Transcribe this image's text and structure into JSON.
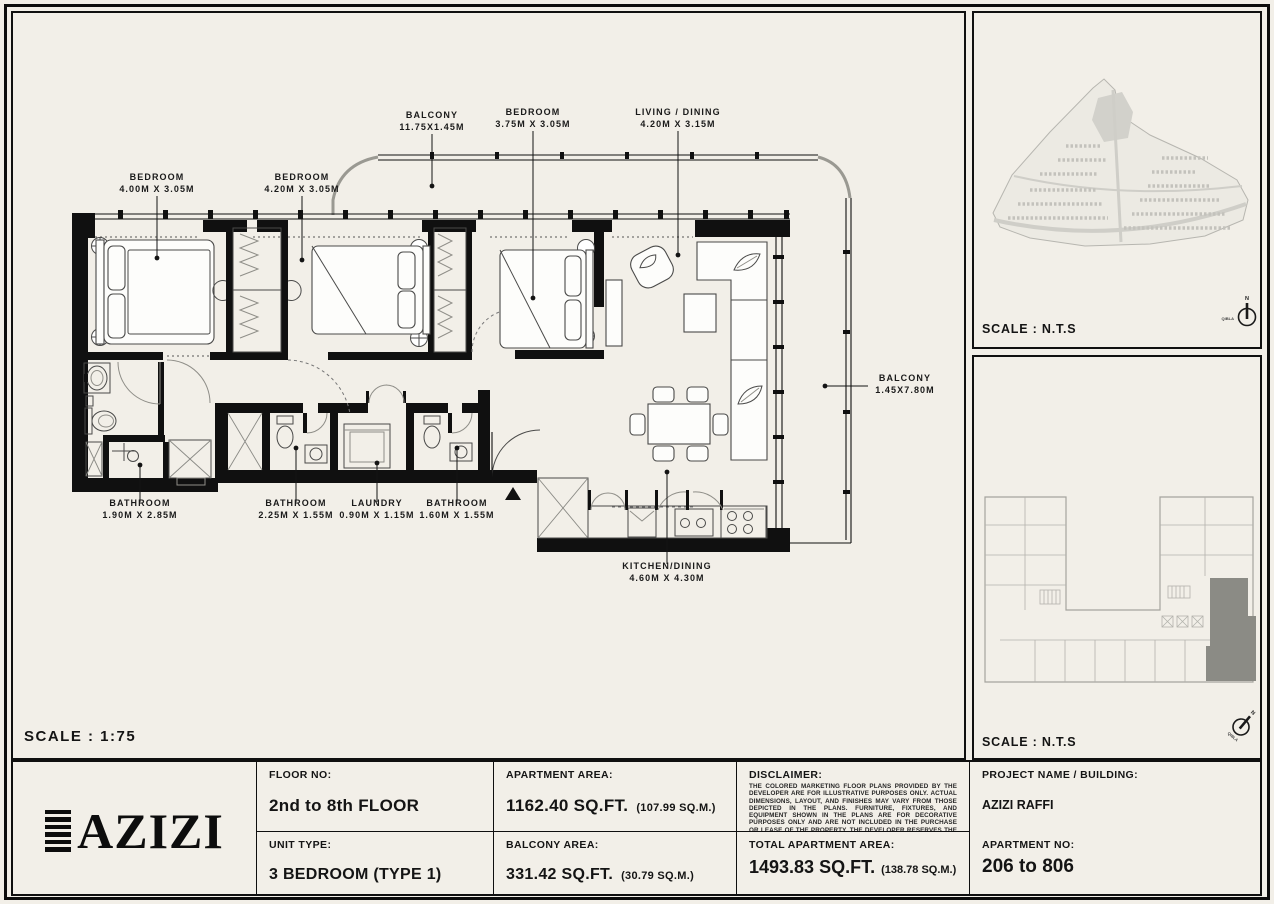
{
  "sheet": {
    "scale_main": "SCALE : 1:75",
    "colors": {
      "paper": "#F2EFE8",
      "ink": "#101010",
      "unit_highlight": "#8B8B85",
      "map_gray": "#C4C3BD"
    }
  },
  "plan": {
    "rooms": [
      {
        "name": "BEDROOM",
        "dims": "4.00M X 3.05M"
      },
      {
        "name": "BEDROOM",
        "dims": "4.20M X 3.05M"
      },
      {
        "name": "BALCONY",
        "dims": "11.75X1.45M"
      },
      {
        "name": "BEDROOM",
        "dims": "3.75M X 3.05M"
      },
      {
        "name": "LIVING / DINING",
        "dims": "4.20M X 3.15M"
      },
      {
        "name": "BALCONY",
        "dims": "1.45X7.80M"
      },
      {
        "name": "BATHROOM",
        "dims": "1.90M X 2.85M"
      },
      {
        "name": "BATHROOM",
        "dims": "2.25M X 1.55M"
      },
      {
        "name": "LAUNDRY",
        "dims": "0.90M X 1.15M"
      },
      {
        "name": "BATHROOM",
        "dims": "1.60M X 1.55M"
      },
      {
        "name": "KITCHEN/DINING",
        "dims": "4.60M X 4.30M"
      }
    ]
  },
  "site_map": {
    "scale_label": "SCALE : N.T.S",
    "compass": {
      "north": "N",
      "qibla": "QIBLA"
    }
  },
  "key_plan": {
    "scale_label": "SCALE : N.T.S",
    "compass": {
      "north": "N",
      "qibla": "QIBLA"
    }
  },
  "info_table": {
    "brand": "AZIZI",
    "floor_no": {
      "label": "FLOOR NO:",
      "value": "2nd to 8th FLOOR"
    },
    "unit_type": {
      "label": "UNIT TYPE:",
      "value": "3 BEDROOM (TYPE 1)"
    },
    "apartment_area": {
      "label": "APARTMENT AREA:",
      "value": "1162.40 SQ.FT.",
      "metric": "(107.99 SQ.M.)"
    },
    "balcony_area": {
      "label": "BALCONY AREA:",
      "value": "331.42 SQ.FT.",
      "metric": "(30.79 SQ.M.)"
    },
    "disclaimer": {
      "label": "DISCLAIMER:",
      "text": "THE COLORED MARKETING FLOOR PLANS PROVIDED BY THE DEVELOPER ARE FOR ILLUSTRATIVE PURPOSES ONLY. ACTUAL DIMENSIONS, LAYOUT, AND FINISHES MAY VARY FROM THOSE DEPICTED IN THE PLANS. FURNITURE, FIXTURES, AND EQUIPMENT SHOWN IN THE PLANS ARE FOR DECORATIVE PURPOSES ONLY AND ARE NOT INCLUDED IN THE PURCHASE OR LEASE OF THE PROPERTY. THE DEVELOPER RESERVES THE RIGHT TO MAKE MODIFICATIONS, REVISIONS, AND CHANGES TO THE FLOOR PLANS, SPECIFICATIONS, AND FEATURES WITHOUT PRIOR NOTICE."
    },
    "total_area": {
      "label": "TOTAL APARTMENT AREA:",
      "value": "1493.83 SQ.FT.",
      "metric": "(138.78 SQ.M.)"
    },
    "project": {
      "label": "PROJECT NAME / BUILDING:",
      "value": "AZIZI RAFFI"
    },
    "apartment_no": {
      "label": "APARTMENT NO:",
      "value": "206 to 806"
    }
  }
}
